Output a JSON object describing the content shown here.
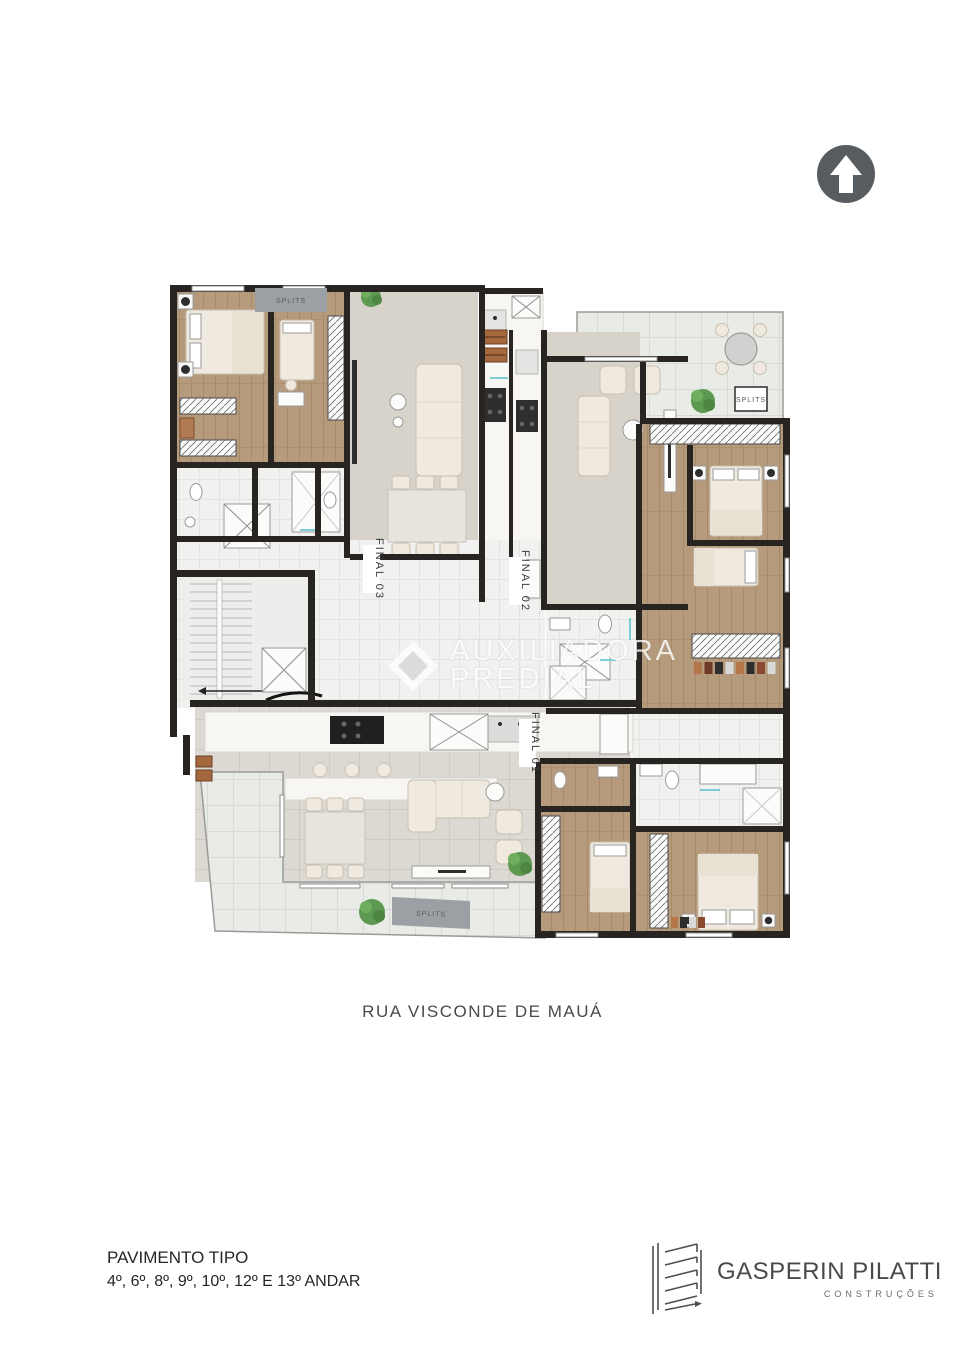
{
  "page": {
    "width": 965,
    "height": 1366,
    "background": "#ffffff"
  },
  "north_arrow": {
    "icon": "up-arrow-icon",
    "circle_color": "#575c60"
  },
  "plan": {
    "unit_labels": {
      "final_03": "FINAL 03",
      "final_02": "FINAL 02",
      "final_01": "FINAL 01"
    },
    "splits": {
      "top": "SPLITS",
      "terrace": "SPLITS",
      "bottom": "SPLITS"
    },
    "colors": {
      "wall": "#282422",
      "wood_floor": "#b69a7c",
      "terrace_tile": "#e9ebe7",
      "hall_tile": "#f1f1ef",
      "living_carpet": "#d7d3cb",
      "gray_tile": "#dcd9d3",
      "marble": "#f7f6f3",
      "furniture": "#efe9df",
      "accent_teal": "#79cfd4",
      "plant_green": "#5d9950",
      "splits_gray": "#9ba0a4"
    }
  },
  "watermark": {
    "line1": "AUXILIADORA",
    "line2": "PREDIAL"
  },
  "street": {
    "label": "RUA VISCONDE DE MAUÁ"
  },
  "footer": {
    "title": "PAVIMENTO TIPO",
    "subtitle": "4º, 6º, 8º, 9º, 10º, 12º E 13º ANDAR"
  },
  "brand": {
    "name": "GASPERIN PILATTI",
    "tagline": "CONSTRUÇÕES"
  }
}
